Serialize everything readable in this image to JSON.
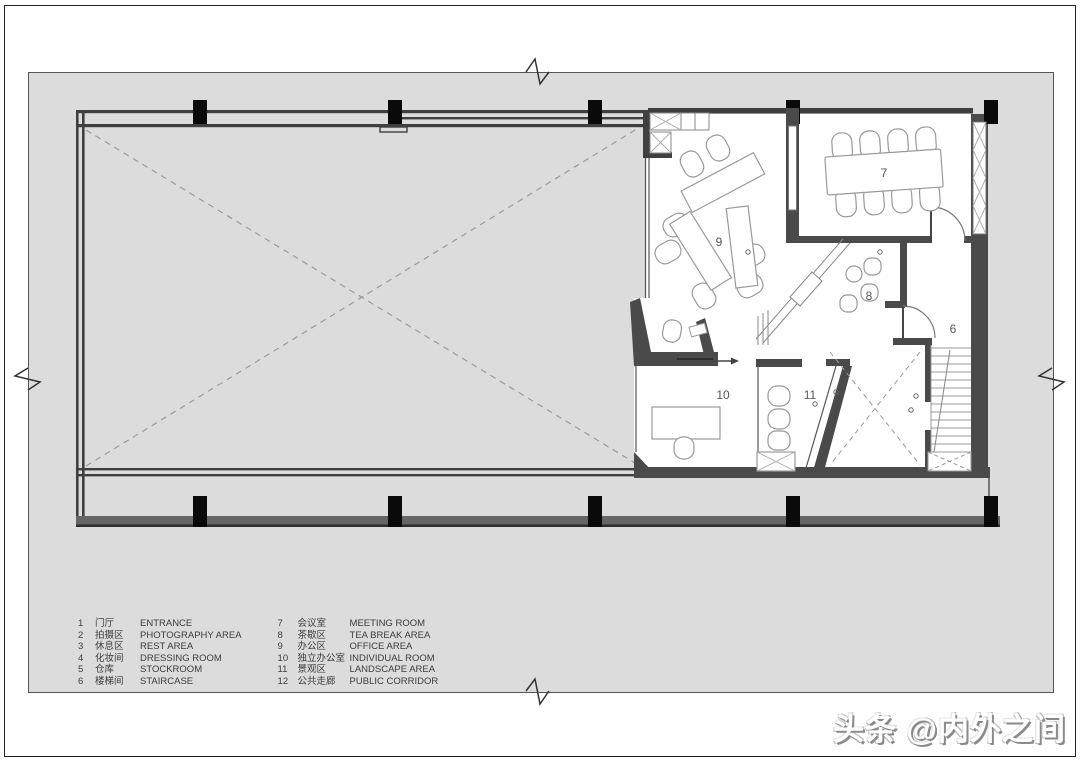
{
  "watermark": {
    "text": "头条 @内外之间"
  },
  "legend": {
    "items": [
      {
        "num": "1",
        "cn": "门厅",
        "en": "ENTRANCE"
      },
      {
        "num": "2",
        "cn": "拍摄区",
        "en": "PHOTOGRAPHY AREA"
      },
      {
        "num": "3",
        "cn": "休息区",
        "en": "REST AREA"
      },
      {
        "num": "4",
        "cn": "化妆间",
        "en": "DRESSING ROOM"
      },
      {
        "num": "5",
        "cn": "仓库",
        "en": "STOCKROOM"
      },
      {
        "num": "6",
        "cn": "楼梯间",
        "en": "STAIRCASE"
      },
      {
        "num": "7",
        "cn": "会议室",
        "en": "MEETING ROOM"
      },
      {
        "num": "8",
        "cn": "茶歇区",
        "en": "TEA BREAK AREA"
      },
      {
        "num": "9",
        "cn": "办公区",
        "en": "OFFICE AREA"
      },
      {
        "num": "10",
        "cn": "独立办公室",
        "en": "INDIVIDUAL ROOM"
      },
      {
        "num": "11",
        "cn": "景观区",
        "en": "LANDSCAPE AREA"
      },
      {
        "num": "12",
        "cn": "公共走廊",
        "en": "PUBLIC CORRIDOR"
      }
    ]
  },
  "plan": {
    "room_labels": [
      {
        "id": "room-6",
        "text": "6"
      },
      {
        "id": "room-7",
        "text": "7"
      },
      {
        "id": "room-8",
        "text": "8"
      },
      {
        "id": "room-9",
        "text": "9"
      },
      {
        "id": "room-10",
        "text": "10"
      },
      {
        "id": "room-11",
        "text": "11"
      }
    ]
  },
  "colors": {
    "canvas": "#dcdcdc",
    "wall_thick": "#4a4a4a",
    "wall_line": "#3f3f3f",
    "column": "#0a0a0a",
    "bottom_band": "#666666",
    "furniture_outline": "#999999",
    "dash_line": "#9a9a9a",
    "label_text": "#555555"
  }
}
